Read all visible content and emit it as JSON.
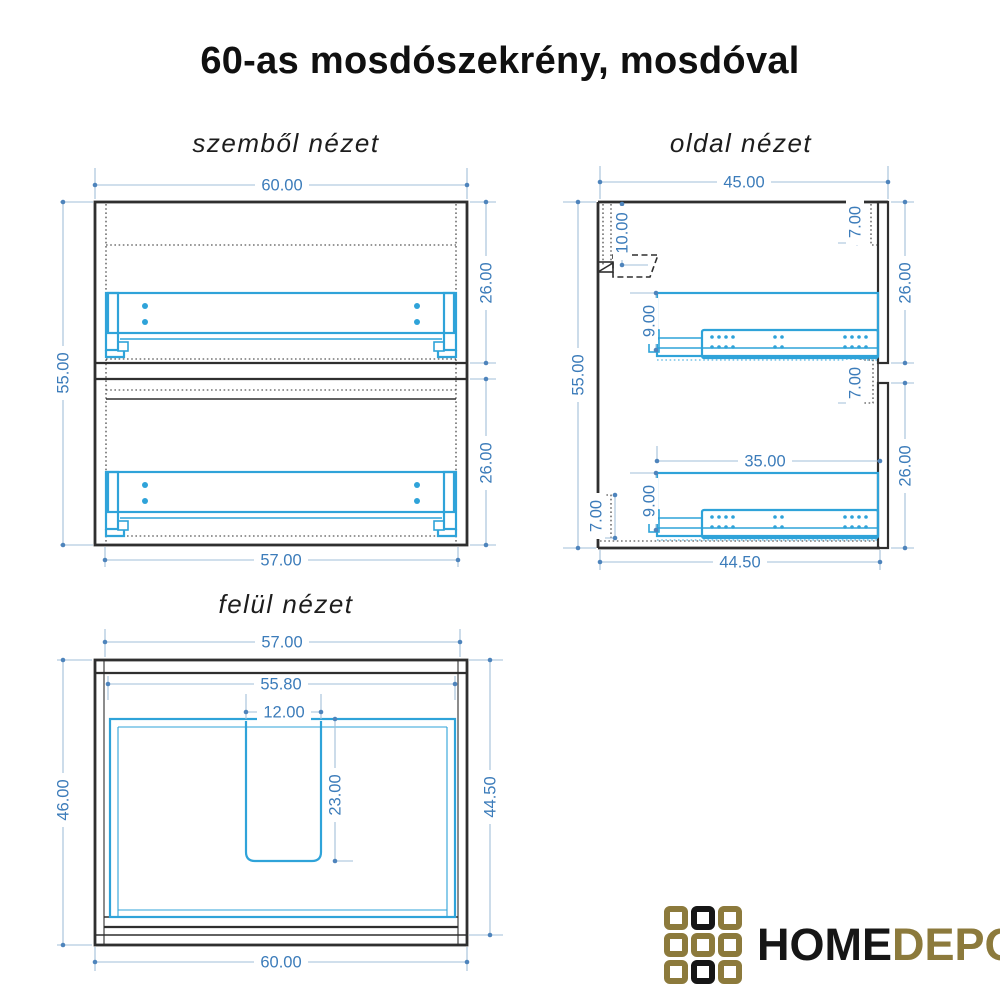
{
  "title": "60-as mosdószekrény, mosdóval",
  "views": {
    "front": {
      "label": "szemből nézet",
      "dims": {
        "width_top": "60.00",
        "height_left": "55.00",
        "upper_drawer_height": "26.00",
        "lower_drawer_height": "26.00",
        "width_bottom": "57.00"
      }
    },
    "side": {
      "label": "oldal nézet",
      "dims": {
        "depth_top": "45.00",
        "height_left": "55.00",
        "sink_inset": "10.00",
        "top_reveal": "7.00",
        "upper_drawer_height": "26.00",
        "upper_rail_offset": "9.00",
        "mid_reveal": "7.00",
        "lower_drawer_height": "26.00",
        "slide_length": "35.00",
        "lower_rail_offset": "9.00",
        "plinth_height": "7.00",
        "depth_bottom": "44.50"
      }
    },
    "top": {
      "label": "felül nézet",
      "dims": {
        "width_top": "57.00",
        "inner_width": "55.80",
        "cutout_width": "12.00",
        "depth_left": "46.00",
        "cutout_depth": "23.00",
        "depth_right": "44.50",
        "width_bottom": "60.00"
      }
    }
  },
  "logo": {
    "word_primary": "HOME",
    "word_secondary": "DEPO",
    "grid": [
      "gold",
      "black",
      "gold",
      "gold",
      "gold",
      "gold",
      "gold",
      "black",
      "gold"
    ],
    "colors": {
      "gold": "#8c7a3c",
      "black": "#161616"
    }
  },
  "colors": {
    "outline": "#2f2f2f",
    "drawer": "#2fa3d9",
    "dimension_text": "#3c7cba",
    "dimension_line": "#a2bfd8",
    "dimension_dot": "#4e84bc",
    "background": "#ffffff"
  }
}
